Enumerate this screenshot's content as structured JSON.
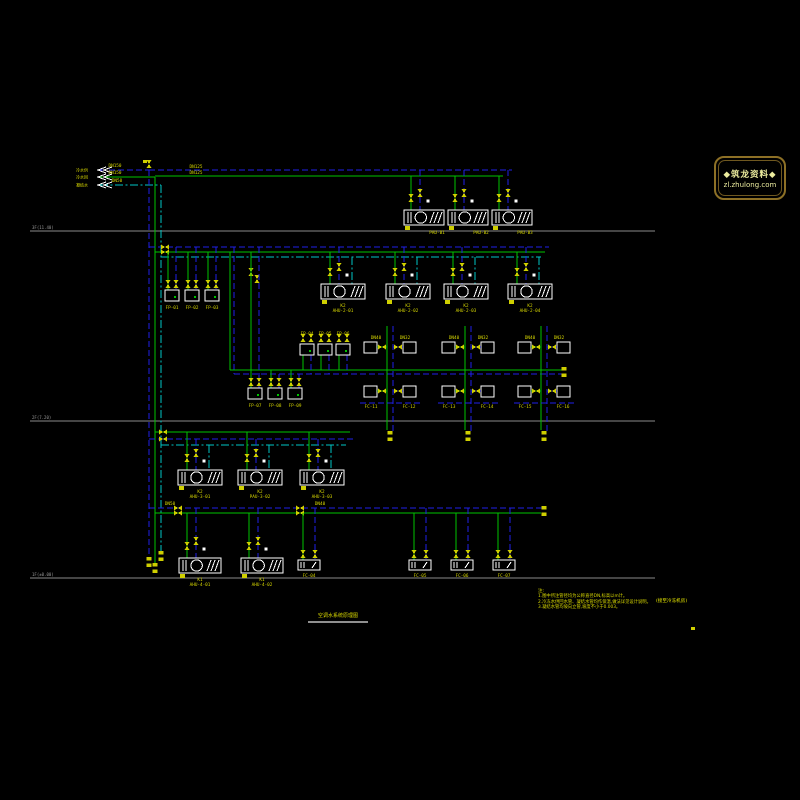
{
  "palette": {
    "sup": "#00c300",
    "ret": "#2020e8",
    "con": "#00c6c6",
    "accent": "#d9d900",
    "valve": "#cfcf00",
    "equip": "#ffffff",
    "floor": "#8a8a8a",
    "floor_text": "#9a9a9a"
  },
  "logo": {
    "line1": "◆筑龙资料◆",
    "line2": "zl.zhulong.com"
  },
  "title": {
    "text": "空调水系统原理图"
  },
  "notes": {
    "heading": "注:",
    "lines": [
      "1.图中所注管径均为公称直径DN,标高以m计。",
      "2.冷冻水供回水管、凝结水管均作保温,做法详见设计说明。",
      "3.凝结水管均坡向立管,坡度不小于0.003。"
    ],
    "side_text": "(接至冷冻机房)"
  },
  "diagram": {
    "floors": [
      {
        "y": 231,
        "x1": 30,
        "x2": 655,
        "label": "3F(11.40)"
      },
      {
        "y": 421,
        "x1": 30,
        "x2": 655,
        "label": "2F(7.20)"
      },
      {
        "y": 578,
        "x1": 30,
        "x2": 655,
        "label": "1F(±0.00)"
      }
    ],
    "sources": [
      {
        "y": 170,
        "name": "冷水供",
        "c": "ret"
      },
      {
        "y": 177,
        "name": "冷水回",
        "c": "sup"
      },
      {
        "y": 185,
        "name": "凝结水",
        "c": "con"
      }
    ],
    "pipes": [
      {
        "t": "h",
        "x1": 100,
        "x2": 149,
        "y": 170,
        "c": "ret"
      },
      {
        "t": "h",
        "x1": 100,
        "x2": 155,
        "y": 177,
        "c": "sup"
      },
      {
        "t": "h",
        "x1": 100,
        "x2": 161,
        "y": 185,
        "c": "con"
      },
      {
        "t": "v",
        "x": 149,
        "y1": 170,
        "y2": 560,
        "c": "ret"
      },
      {
        "t": "v",
        "x": 155,
        "y1": 177,
        "y2": 566,
        "c": "sup"
      },
      {
        "t": "v",
        "x": 161,
        "y1": 185,
        "y2": 554,
        "c": "con"
      },
      {
        "t": "h",
        "x1": 149,
        "x2": 512,
        "y": 170,
        "c": "ret"
      },
      {
        "t": "h",
        "x1": 155,
        "x2": 503,
        "y": 176,
        "c": "sup"
      },
      {
        "t": "h",
        "x1": 149,
        "x2": 549,
        "y": 247,
        "c": "ret"
      },
      {
        "t": "h",
        "x1": 155,
        "x2": 545,
        "y": 252,
        "c": "sup"
      },
      {
        "t": "h",
        "x1": 161,
        "x2": 541,
        "y": 257,
        "c": "con"
      },
      {
        "t": "v",
        "x": 230,
        "y1": 252,
        "y2": 370,
        "c": "sup"
      },
      {
        "t": "v",
        "x": 234,
        "y1": 247,
        "y2": 374,
        "c": "ret"
      },
      {
        "t": "h",
        "x1": 230,
        "x2": 562,
        "y": 370,
        "c": "sup"
      },
      {
        "t": "h",
        "x1": 234,
        "x2": 566,
        "y": 374,
        "c": "ret"
      },
      {
        "t": "h",
        "x1": 155,
        "x2": 350,
        "y": 432,
        "c": "sup"
      },
      {
        "t": "h",
        "x1": 149,
        "x2": 354,
        "y": 439,
        "c": "ret"
      },
      {
        "t": "h",
        "x1": 161,
        "x2": 346,
        "y": 445,
        "c": "con"
      },
      {
        "t": "h",
        "x1": 149,
        "x2": 545,
        "y": 508,
        "c": "ret"
      },
      {
        "t": "h",
        "x1": 155,
        "x2": 541,
        "y": 513,
        "c": "sup"
      }
    ],
    "valves": [
      {
        "x": 149,
        "y": 164,
        "o": "v"
      },
      {
        "x": 165,
        "y": 247,
        "o": "h"
      },
      {
        "x": 165,
        "y": 252,
        "o": "h"
      },
      {
        "x": 251,
        "y": 272,
        "o": "v"
      },
      {
        "x": 257,
        "y": 279,
        "o": "v"
      },
      {
        "x": 163,
        "y": 432,
        "o": "h"
      },
      {
        "x": 163,
        "y": 439,
        "o": "h"
      },
      {
        "x": 178,
        "y": 508,
        "o": "h"
      },
      {
        "x": 178,
        "y": 513,
        "o": "h"
      },
      {
        "x": 300,
        "y": 508,
        "o": "h"
      },
      {
        "x": 300,
        "y": 513,
        "o": "h"
      }
    ],
    "endcaps": [
      {
        "x": 149,
        "y": 562
      },
      {
        "x": 155,
        "y": 568
      },
      {
        "x": 161,
        "y": 556
      },
      {
        "x": 564,
        "y": 372
      },
      {
        "x": 544,
        "y": 511
      }
    ],
    "ahus": [
      {
        "cx": 424,
        "y": 210,
        "w": 40,
        "fs": 176,
        "fr": 170,
        "fc": null,
        "labels": [
          "PAU-B1"
        ]
      },
      {
        "cx": 468,
        "y": 210,
        "w": 40,
        "fs": 176,
        "fr": 170,
        "fc": null,
        "labels": [
          "PAU-B2"
        ]
      },
      {
        "cx": 512,
        "y": 210,
        "w": 40,
        "fs": 176,
        "fr": 170,
        "fc": null,
        "labels": [
          "PAU-B3"
        ]
      },
      {
        "cx": 343,
        "y": 284,
        "w": 44,
        "fs": 252,
        "fr": 247,
        "fc": 257,
        "labels": [
          "K2",
          "AHU-2-01"
        ]
      },
      {
        "cx": 408,
        "y": 284,
        "w": 44,
        "fs": 252,
        "fr": 247,
        "fc": 257,
        "labels": [
          "K2",
          "AHU-2-02"
        ]
      },
      {
        "cx": 466,
        "y": 284,
        "w": 44,
        "fs": 252,
        "fr": 247,
        "fc": 257,
        "labels": [
          "K2",
          "AHU-2-03"
        ]
      },
      {
        "cx": 530,
        "y": 284,
        "w": 44,
        "fs": 252,
        "fr": 247,
        "fc": 257,
        "labels": [
          "K2",
          "AHU-2-04"
        ]
      },
      {
        "cx": 200,
        "y": 470,
        "w": 44,
        "fs": 432,
        "fr": 439,
        "fc": 445,
        "labels": [
          "K2",
          "AHU-3-01"
        ]
      },
      {
        "cx": 260,
        "y": 470,
        "w": 44,
        "fs": 432,
        "fr": 439,
        "fc": 445,
        "labels": [
          "K2",
          "PAU-3-02"
        ]
      },
      {
        "cx": 322,
        "y": 470,
        "w": 44,
        "fs": 432,
        "fr": 439,
        "fc": 445,
        "labels": [
          "K2",
          "AHU-3-03"
        ]
      },
      {
        "cx": 200,
        "y": 558,
        "w": 42,
        "fs": 513,
        "fr": 508,
        "fc": null,
        "labels": [
          "K1",
          "AHU-4-01"
        ]
      },
      {
        "cx": 262,
        "y": 558,
        "w": 42,
        "fs": 513,
        "fr": 508,
        "fc": null,
        "labels": [
          "K1",
          "AHU-4-02"
        ]
      }
    ],
    "fcus": [
      {
        "cx": 172,
        "y": 290,
        "fs": 252,
        "fr": 247,
        "label": "FP-01",
        "lpos": "below"
      },
      {
        "cx": 192,
        "y": 290,
        "fs": 252,
        "fr": 247,
        "label": "FP-02",
        "lpos": "below"
      },
      {
        "cx": 212,
        "y": 290,
        "fs": 252,
        "fr": 247,
        "label": "FP-03",
        "lpos": "below"
      },
      {
        "cx": 307,
        "y": 344,
        "fs": 370,
        "fr": 374,
        "label": "FP-04",
        "lpos": "above"
      },
      {
        "cx": 325,
        "y": 344,
        "fs": 370,
        "fr": 374,
        "label": "FP-05",
        "lpos": "above"
      },
      {
        "cx": 343,
        "y": 344,
        "fs": 370,
        "fr": 374,
        "label": "FP-06",
        "lpos": "above"
      },
      {
        "cx": 255,
        "y": 388,
        "fs": 252,
        "fr": 247,
        "label": "FP-07",
        "lpos": "below"
      },
      {
        "cx": 275,
        "y": 388,
        "fs": 370,
        "fr": 374,
        "label": "FP-08",
        "lpos": "below"
      },
      {
        "cx": 295,
        "y": 388,
        "fs": 370,
        "fr": 374,
        "label": "FP-09",
        "lpos": "below"
      }
    ],
    "wide_fcs": [
      {
        "cx": 309,
        "y": 560,
        "fs": 513,
        "fr": 508,
        "label": "FC-04"
      },
      {
        "cx": 420,
        "y": 560,
        "fs": 513,
        "fr": 508,
        "label": "FC-05"
      },
      {
        "cx": 462,
        "y": 560,
        "fs": 513,
        "fr": 508,
        "label": "FC-06"
      },
      {
        "cx": 504,
        "y": 560,
        "fs": 513,
        "fr": 508,
        "label": "FC-07"
      }
    ],
    "crossers": [
      {
        "x": 390,
        "dn": [
          "DN40",
          "DN32"
        ],
        "fc": [
          "FC-11",
          "FC-12"
        ]
      },
      {
        "x": 468,
        "dn": [
          "DN40",
          "DN32"
        ],
        "fc": [
          "FC-13",
          "FC-14"
        ]
      },
      {
        "x": 544,
        "dn": [
          "DN40",
          "DN32"
        ],
        "fc": [
          "FC-15",
          "FC-16"
        ]
      }
    ],
    "labels": [
      {
        "x": 115,
        "y": 167,
        "t": "DN150"
      },
      {
        "x": 115,
        "y": 174,
        "t": "DN150"
      },
      {
        "x": 117,
        "y": 182,
        "t": "DN50"
      },
      {
        "x": 196,
        "y": 168,
        "t": "DN125"
      },
      {
        "x": 196,
        "y": 174,
        "t": "DN125"
      },
      {
        "x": 170,
        "y": 505,
        "t": "DN50"
      },
      {
        "x": 320,
        "y": 505,
        "t": "DN40"
      }
    ],
    "marks": [
      {
        "x": 691,
        "y": 627,
        "w": 4,
        "h": 3
      },
      {
        "x": 143,
        "y": 160,
        "w": 4,
        "h": 3
      }
    ]
  }
}
